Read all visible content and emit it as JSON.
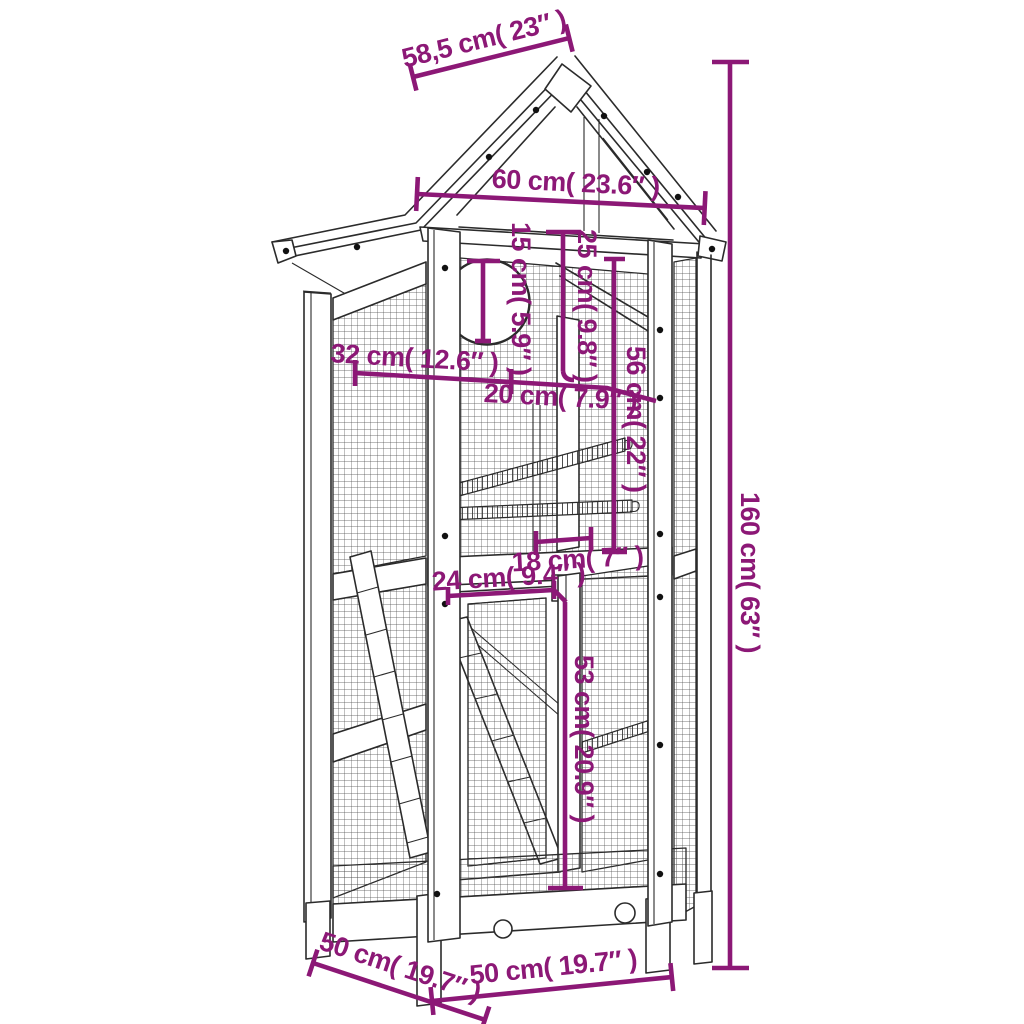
{
  "diagram": {
    "product": "wooden bird aviary with gable roof",
    "accent_color": "#8C1876",
    "line_color": "#2b2b2b",
    "background": "#ffffff"
  },
  "dimensions": {
    "roof_slope": "58,5 cm( 23″ )",
    "roof_width": "60 cm( 23.6″ )",
    "entry_hole": "15 cm( 5.9″ )",
    "inner_height": "25 cm( 9.8″ )",
    "upper_height": "56 cm( 22″ )",
    "side_upper_depth": "32 cm( 12.6″ )",
    "inner_width": "20 cm( 7.9″ )",
    "gap_width": "18 cm( 7″ )",
    "door_width": "24 cm( 9.4″ )",
    "lower_height": "53 cm( 20.9″ )",
    "total_height": "160 cm( 63″ )",
    "base_depth": "50 cm( 19.7″ )",
    "base_width": "50 cm( 19.7″ )"
  }
}
